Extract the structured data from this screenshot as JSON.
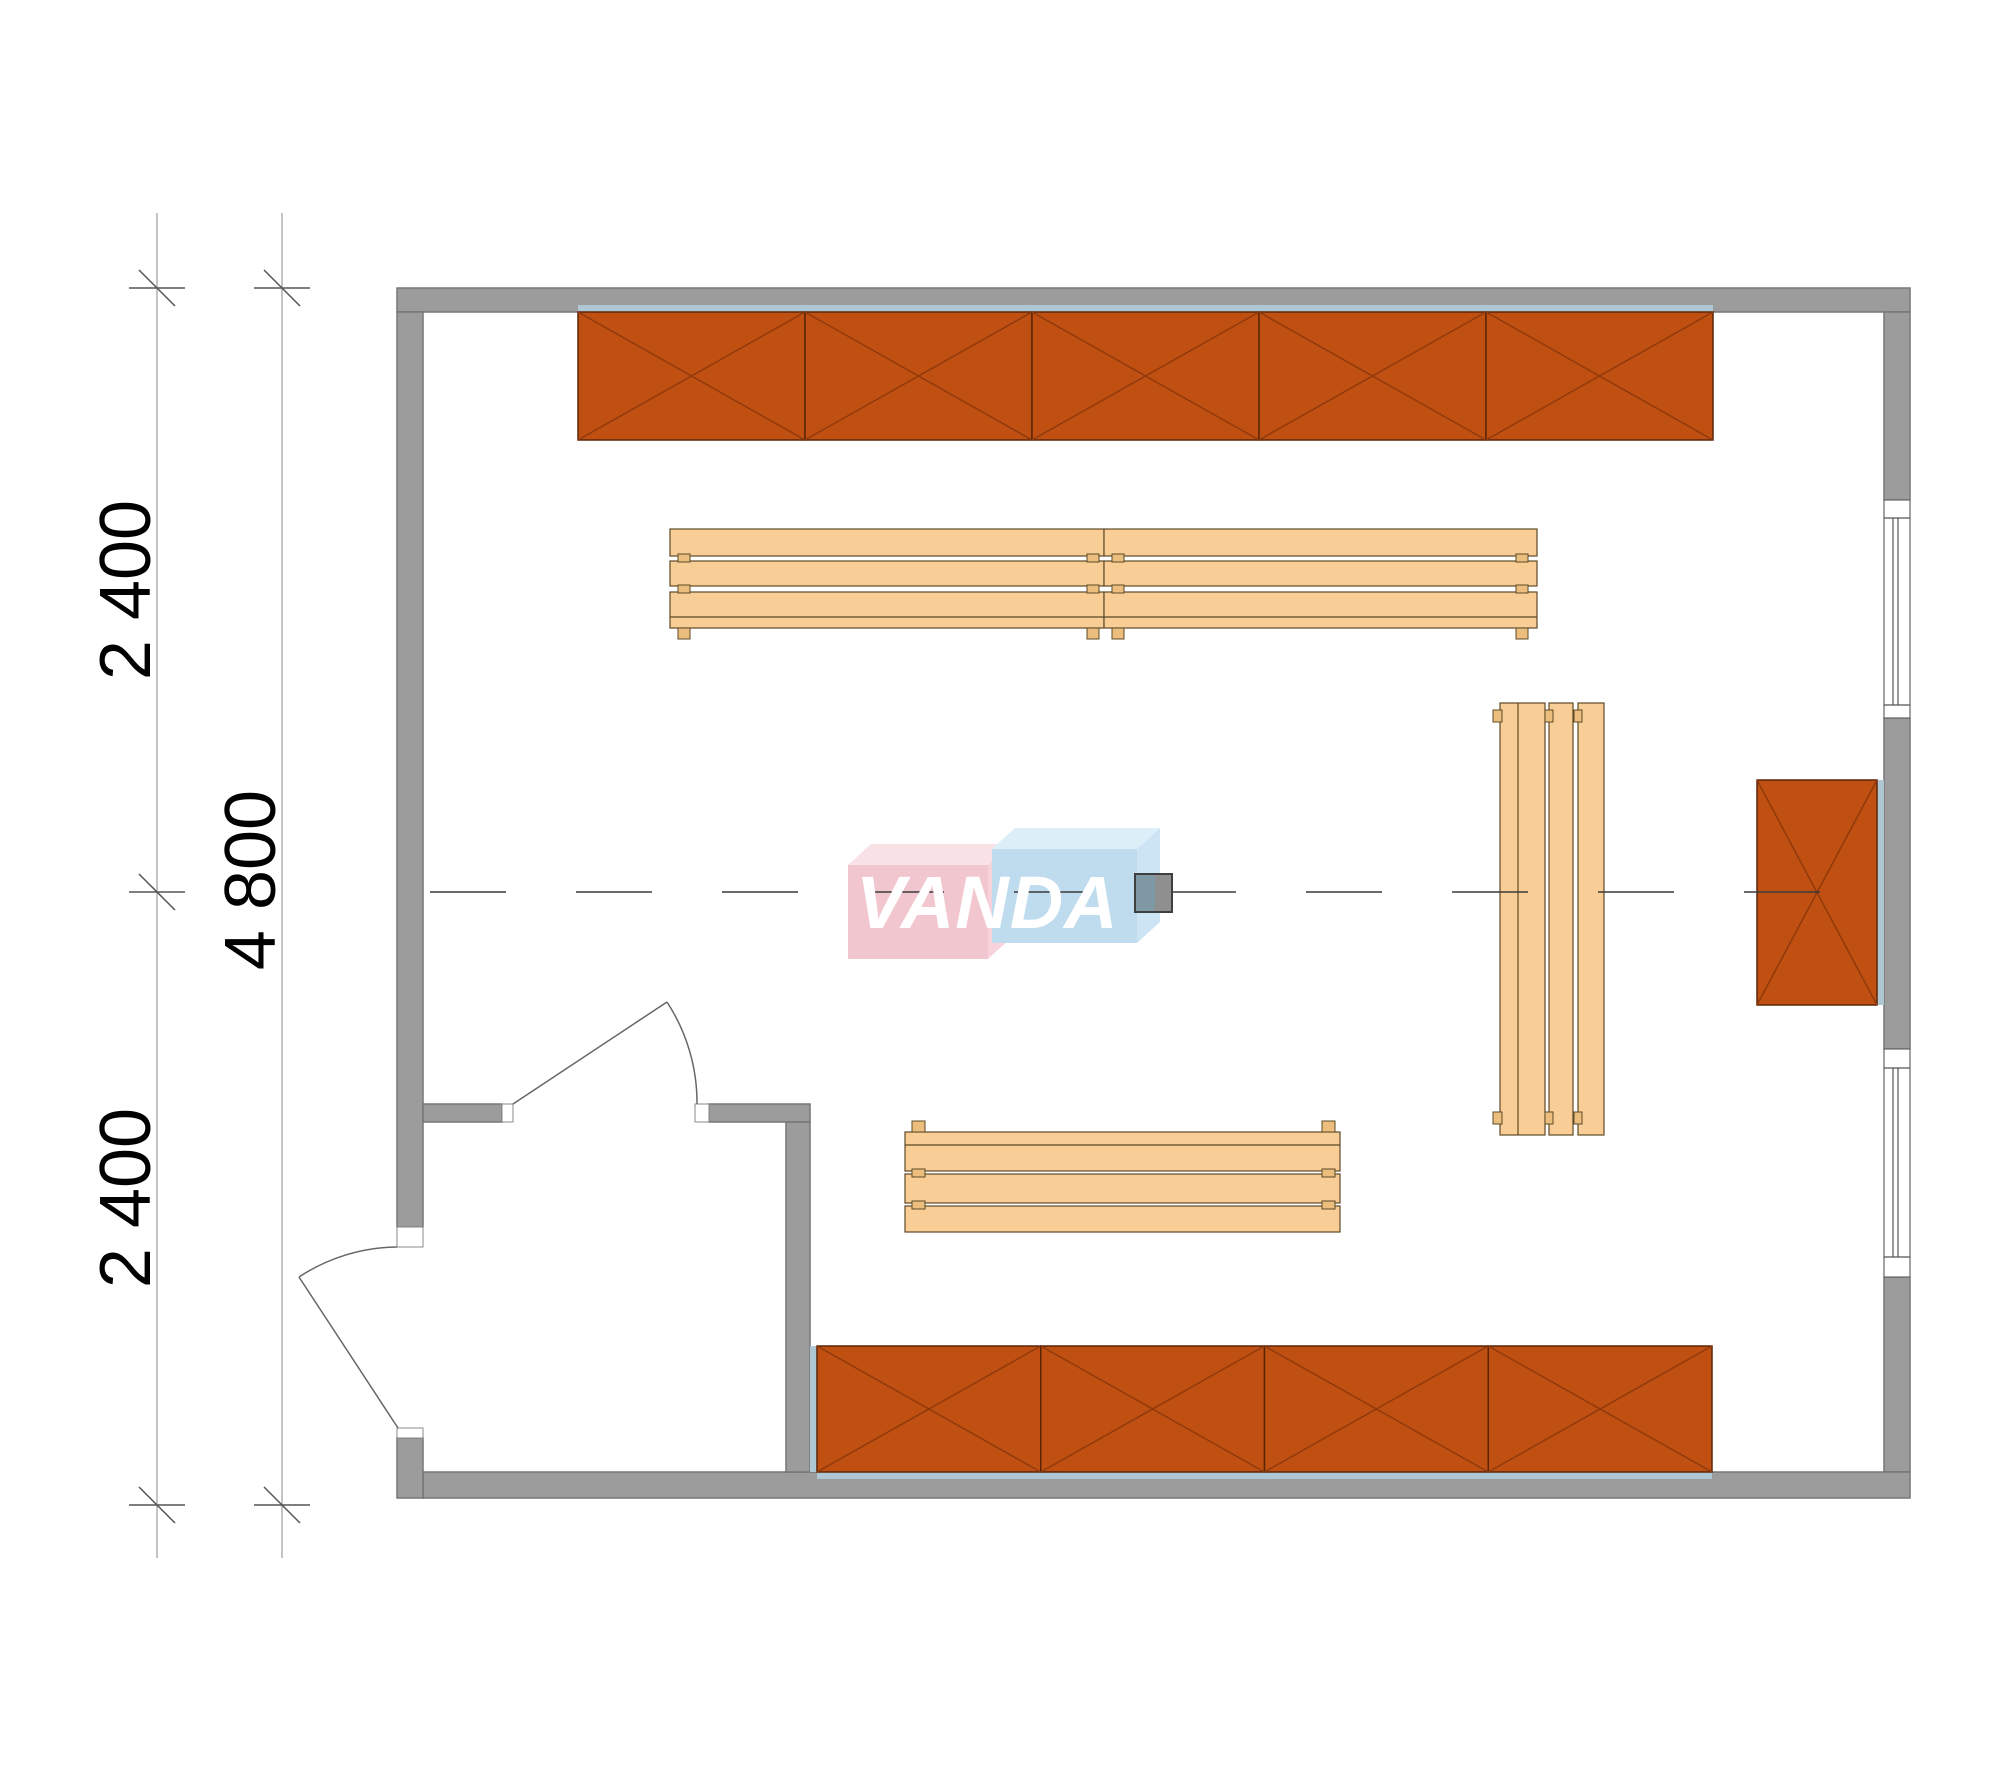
{
  "dimensions": {
    "left_top": "2 400",
    "left_bottom": "2 400",
    "left_total": "4 800"
  },
  "logo": {
    "text": "VANDA"
  },
  "colors": {
    "wall_gray": "#9c9c9c",
    "shelf_orange": "#c05012",
    "bench_wood": "#f9ce96",
    "backing_blue": "#aec7d2",
    "logo_pink": "#f2c6ce",
    "logo_blue": "#bfdcee",
    "column_teal": "#7e98a4",
    "column_gray": "#8f8f8f"
  },
  "plan": {
    "canvas": {
      "width": 2000,
      "height": 1786
    },
    "layers": [
      {
        "kind": "rect",
        "name": "walls",
        "items": [
          {
            "x": 397,
            "y": 288,
            "w": 1513,
            "h": 24,
            "cls": "wall",
            "name": "wall-top"
          },
          {
            "x": 397,
            "y": 312,
            "w": 26,
            "h": 915,
            "cls": "wall",
            "name": "wall-left"
          },
          {
            "x": 1884,
            "y": 312,
            "w": 26,
            "h": 188,
            "cls": "wall",
            "name": "wall-right-upper"
          },
          {
            "x": 1884,
            "y": 718,
            "w": 26,
            "h": 331,
            "cls": "wall",
            "name": "wall-right-middle"
          },
          {
            "x": 1884,
            "y": 1277,
            "w": 26,
            "h": 195,
            "cls": "wall",
            "name": "wall-right-lower"
          },
          {
            "x": 423,
            "y": 1472,
            "w": 1487,
            "h": 26,
            "cls": "wall",
            "name": "wall-bottom"
          },
          {
            "x": 397,
            "y": 1438,
            "w": 26,
            "h": 60,
            "cls": "wall",
            "name": "wall-entry-stub"
          },
          {
            "x": 423,
            "y": 1104,
            "w": 79,
            "h": 18,
            "cls": "wall",
            "name": "wall-vestibule-left"
          },
          {
            "x": 709,
            "y": 1104,
            "w": 101,
            "h": 18,
            "cls": "wall",
            "name": "wall-vestibule-right"
          },
          {
            "x": 786,
            "y": 1122,
            "w": 24,
            "h": 350,
            "cls": "wall",
            "name": "wall-vestibule-vertical"
          }
        ]
      },
      {
        "kind": "rect",
        "name": "backing-strips",
        "items": [
          {
            "x": 578,
            "y": 305,
            "w": 1135,
            "h": 8,
            "cls": "strip",
            "name": "backing-strip-top"
          },
          {
            "x": 810,
            "y": 1346,
            "w": 7,
            "h": 126,
            "cls": "strip",
            "name": "backing-strip-bottom-left"
          },
          {
            "x": 817,
            "y": 1472,
            "w": 895,
            "h": 7,
            "cls": "strip",
            "name": "backing-strip-bottom"
          },
          {
            "x": 1877,
            "y": 780,
            "w": 7,
            "h": 225,
            "cls": "strip",
            "name": "backing-strip-right"
          }
        ]
      },
      {
        "kind": "rect",
        "name": "door-jambs",
        "items": [
          {
            "x": 502,
            "y": 1104,
            "w": 11,
            "h": 18,
            "cls": "jamb",
            "name": "jamb-interior-left"
          },
          {
            "x": 695,
            "y": 1104,
            "w": 14,
            "h": 18,
            "cls": "jamb",
            "name": "jamb-interior-right"
          },
          {
            "x": 397,
            "y": 1227,
            "w": 26,
            "h": 20,
            "cls": "jamb",
            "name": "jamb-entry-top"
          },
          {
            "x": 397,
            "y": 1428,
            "w": 26,
            "h": 10,
            "cls": "jamb",
            "name": "jamb-entry-bottom"
          }
        ]
      },
      {
        "kind": "rect",
        "name": "windows",
        "items": [
          {
            "x": 1884,
            "y": 500,
            "w": 26,
            "h": 218,
            "cls": "winframe",
            "name": "window-upper"
          },
          {
            "x": 1884,
            "y": 1049,
            "w": 26,
            "h": 228,
            "cls": "winframe",
            "name": "window-lower"
          }
        ]
      },
      {
        "kind": "hatch",
        "name": "shelving",
        "items": [
          {
            "x": 578,
            "y": 312,
            "w": 1135,
            "h": 128,
            "units": 5,
            "name": "shelf-row-top"
          },
          {
            "x": 817,
            "y": 1346,
            "w": 895,
            "h": 126,
            "units": 4,
            "name": "shelf-row-bottom"
          },
          {
            "x": 1757,
            "y": 780,
            "w": 120,
            "h": 225,
            "units": 1,
            "name": "wall-cabinet-right"
          }
        ]
      },
      {
        "kind": "rect",
        "name": "bench-slats",
        "items": [
          {
            "x": 670,
            "y": 529,
            "w": 434,
            "h": 27,
            "cls": "slat",
            "name": "bench-top-left-slat-1"
          },
          {
            "x": 670,
            "y": 561,
            "w": 434,
            "h": 25,
            "cls": "slat",
            "name": "bench-top-left-slat-2"
          },
          {
            "x": 670,
            "y": 592,
            "w": 434,
            "h": 36,
            "cls": "slat",
            "name": "bench-top-left-slat-3"
          },
          {
            "x": 1104,
            "y": 529,
            "w": 433,
            "h": 27,
            "cls": "slat",
            "name": "bench-top-right-slat-1"
          },
          {
            "x": 1104,
            "y": 561,
            "w": 433,
            "h": 25,
            "cls": "slat",
            "name": "bench-top-right-slat-2"
          },
          {
            "x": 1104,
            "y": 592,
            "w": 433,
            "h": 36,
            "cls": "slat",
            "name": "bench-top-right-slat-3"
          },
          {
            "x": 905,
            "y": 1132,
            "w": 435,
            "h": 39,
            "cls": "slat",
            "name": "bench-bottom-slat-1"
          },
          {
            "x": 905,
            "y": 1174,
            "w": 435,
            "h": 29,
            "cls": "slat",
            "name": "bench-bottom-slat-2"
          },
          {
            "x": 905,
            "y": 1206,
            "w": 435,
            "h": 26,
            "cls": "slat",
            "name": "bench-bottom-slat-3"
          },
          {
            "x": 1500,
            "y": 703,
            "w": 45,
            "h": 432,
            "cls": "slat",
            "name": "bench-vertical-slat-1"
          },
          {
            "x": 1549,
            "y": 703,
            "w": 24,
            "h": 432,
            "cls": "slat",
            "name": "bench-vertical-slat-2"
          },
          {
            "x": 1578,
            "y": 703,
            "w": 26,
            "h": 432,
            "cls": "slat",
            "name": "bench-vertical-slat-3"
          }
        ]
      },
      {
        "kind": "rect",
        "name": "bench-legs",
        "items": [
          {
            "x": 678,
            "y": 554,
            "w": 12,
            "h": 8,
            "cls": "leg",
            "name": "bench-leg"
          },
          {
            "x": 1087,
            "y": 554,
            "w": 12,
            "h": 8,
            "cls": "leg",
            "name": "bench-leg"
          },
          {
            "x": 1112,
            "y": 554,
            "w": 12,
            "h": 8,
            "cls": "leg",
            "name": "bench-leg"
          },
          {
            "x": 1516,
            "y": 554,
            "w": 12,
            "h": 8,
            "cls": "leg",
            "name": "bench-leg"
          },
          {
            "x": 678,
            "y": 585,
            "w": 12,
            "h": 8,
            "cls": "leg",
            "name": "bench-leg"
          },
          {
            "x": 1087,
            "y": 585,
            "w": 12,
            "h": 8,
            "cls": "leg",
            "name": "bench-leg"
          },
          {
            "x": 1112,
            "y": 585,
            "w": 12,
            "h": 8,
            "cls": "leg",
            "name": "bench-leg"
          },
          {
            "x": 1516,
            "y": 585,
            "w": 12,
            "h": 8,
            "cls": "leg",
            "name": "bench-leg"
          },
          {
            "x": 678,
            "y": 628,
            "w": 12,
            "h": 11,
            "cls": "leg",
            "name": "bench-leg"
          },
          {
            "x": 1087,
            "y": 628,
            "w": 12,
            "h": 11,
            "cls": "leg",
            "name": "bench-leg"
          },
          {
            "x": 1112,
            "y": 628,
            "w": 12,
            "h": 11,
            "cls": "leg",
            "name": "bench-leg"
          },
          {
            "x": 1516,
            "y": 628,
            "w": 12,
            "h": 11,
            "cls": "leg",
            "name": "bench-leg"
          },
          {
            "x": 912,
            "y": 1121,
            "w": 13,
            "h": 11,
            "cls": "leg",
            "name": "bench-leg"
          },
          {
            "x": 1322,
            "y": 1121,
            "w": 13,
            "h": 11,
            "cls": "leg",
            "name": "bench-leg"
          },
          {
            "x": 912,
            "y": 1169,
            "w": 13,
            "h": 8,
            "cls": "leg",
            "name": "bench-leg"
          },
          {
            "x": 1322,
            "y": 1169,
            "w": 13,
            "h": 8,
            "cls": "leg",
            "name": "bench-leg"
          },
          {
            "x": 912,
            "y": 1201,
            "w": 13,
            "h": 8,
            "cls": "leg",
            "name": "bench-leg"
          },
          {
            "x": 1322,
            "y": 1201,
            "w": 13,
            "h": 8,
            "cls": "leg",
            "name": "bench-leg"
          },
          {
            "x": 1493,
            "y": 710,
            "w": 9,
            "h": 12,
            "cls": "leg",
            "name": "bench-leg"
          },
          {
            "x": 1545,
            "y": 710,
            "w": 8,
            "h": 12,
            "cls": "leg",
            "name": "bench-leg"
          },
          {
            "x": 1574,
            "y": 710,
            "w": 8,
            "h": 12,
            "cls": "leg",
            "name": "bench-leg"
          },
          {
            "x": 1493,
            "y": 1112,
            "w": 9,
            "h": 12,
            "cls": "leg",
            "name": "bench-leg"
          },
          {
            "x": 1545,
            "y": 1112,
            "w": 8,
            "h": 12,
            "cls": "leg",
            "name": "bench-leg"
          },
          {
            "x": 1574,
            "y": 1112,
            "w": 8,
            "h": 12,
            "cls": "leg",
            "name": "bench-leg"
          }
        ]
      },
      {
        "kind": "line",
        "name": "detail-lines",
        "items": [
          {
            "x1": 670,
            "y1": 617,
            "x2": 1104,
            "y2": 617,
            "cls": "slatline",
            "name": "bench-board-line"
          },
          {
            "x1": 1104,
            "y1": 617,
            "x2": 1537,
            "y2": 617,
            "cls": "slatline",
            "name": "bench-board-line"
          },
          {
            "x1": 905,
            "y1": 1145,
            "x2": 1340,
            "y2": 1145,
            "cls": "slatline",
            "name": "bench-board-line"
          },
          {
            "x1": 1518,
            "y1": 703,
            "x2": 1518,
            "y2": 1135,
            "cls": "slatline",
            "name": "bench-board-line"
          },
          {
            "x1": 1884,
            "y1": 518,
            "x2": 1910,
            "y2": 518,
            "cls": "thinline",
            "name": "window-frame-line"
          },
          {
            "x1": 1884,
            "y1": 705,
            "x2": 1910,
            "y2": 705,
            "cls": "thinline",
            "name": "window-frame-line"
          },
          {
            "x1": 1893,
            "y1": 518,
            "x2": 1893,
            "y2": 705,
            "cls": "thinline",
            "name": "window-glass-line"
          },
          {
            "x1": 1898,
            "y1": 518,
            "x2": 1898,
            "y2": 705,
            "cls": "thinline",
            "name": "window-glass-line"
          },
          {
            "x1": 1884,
            "y1": 1068,
            "x2": 1910,
            "y2": 1068,
            "cls": "thinline",
            "name": "window-frame-line"
          },
          {
            "x1": 1884,
            "y1": 1257,
            "x2": 1910,
            "y2": 1257,
            "cls": "thinline",
            "name": "window-frame-line"
          },
          {
            "x1": 1893,
            "y1": 1068,
            "x2": 1893,
            "y2": 1257,
            "cls": "thinline",
            "name": "window-glass-line"
          },
          {
            "x1": 1898,
            "y1": 1068,
            "x2": 1898,
            "y2": 1257,
            "cls": "thinline",
            "name": "window-glass-line"
          }
        ]
      },
      {
        "kind": "poly",
        "name": "vanda-watermark-boxes",
        "items": [
          {
            "pts": "848,865 871,844 1011,844 988,865",
            "cls": "logo-pink-top",
            "name": "logo-pink-box-top"
          },
          {
            "pts": "988,865 1011,844 1011,938 988,959",
            "cls": "logo-pink-side",
            "name": "logo-pink-box-side"
          },
          {
            "pts": "848,865 988,865 988,959 848,959",
            "cls": "logo-pink-face",
            "name": "logo-pink-box-face"
          },
          {
            "pts": "992,849 1015,828 1160,828 1137,849",
            "cls": "logo-blue-top",
            "name": "logo-blue-box-top"
          },
          {
            "pts": "1137,849 1160,828 1160,922 1137,943",
            "cls": "logo-blue-side",
            "name": "logo-blue-box-side"
          },
          {
            "pts": "992,849 1137,849 1137,943 992,943",
            "cls": "logo-blue-face",
            "name": "logo-blue-box-face"
          }
        ]
      },
      {
        "kind": "line",
        "name": "center-axis",
        "items": [
          {
            "x1": 430,
            "y1": 892,
            "x2": 1884,
            "y2": 892,
            "cls": "dashline",
            "name": "center-axis-line"
          }
        ]
      },
      {
        "kind": "path",
        "name": "doors",
        "items": [
          {
            "d": "M 398 1428 L 299 1277",
            "cls": "doorline",
            "name": "entry-door-leaf"
          },
          {
            "d": "M 299 1277 A 181 181 0 0 1 397 1247",
            "cls": "doorline",
            "name": "entry-door-swing-arc"
          },
          {
            "d": "M 513 1104 L 667 1002",
            "cls": "doorline",
            "name": "interior-door-leaf"
          },
          {
            "d": "M 667 1002 A 184 184 0 0 1 697 1104",
            "cls": "doorline",
            "name": "interior-door-swing-arc"
          }
        ]
      },
      {
        "kind": "rect",
        "name": "center-column",
        "items": [
          {
            "x": 1135,
            "y": 874,
            "w": 20,
            "h": 38,
            "cls": "col-left",
            "name": "column-left-half"
          },
          {
            "x": 1155,
            "y": 874,
            "w": 17,
            "h": 38,
            "cls": "col-right",
            "name": "column-right-half"
          },
          {
            "x": 1135,
            "y": 874,
            "w": 37,
            "h": 38,
            "cls": "col-border",
            "name": "column-outline"
          }
        ]
      },
      {
        "kind": "line",
        "name": "dimension-lines",
        "items": [
          {
            "x1": 157,
            "y1": 213,
            "x2": 157,
            "y2": 1558,
            "cls": "dimline",
            "name": "dimension-chain-line"
          },
          {
            "x1": 282,
            "y1": 213,
            "x2": 282,
            "y2": 1558,
            "cls": "dimline",
            "name": "dimension-total-line"
          }
        ]
      },
      {
        "kind": "tick",
        "name": "dimension-ticks",
        "items": [
          {
            "x": 157,
            "y": 288,
            "name": "dim-tick"
          },
          {
            "x": 157,
            "y": 892,
            "name": "dim-tick"
          },
          {
            "x": 157,
            "y": 1505,
            "name": "dim-tick"
          },
          {
            "x": 282,
            "y": 288,
            "name": "dim-tick"
          },
          {
            "x": 282,
            "y": 1505,
            "name": "dim-tick"
          }
        ]
      }
    ]
  }
}
